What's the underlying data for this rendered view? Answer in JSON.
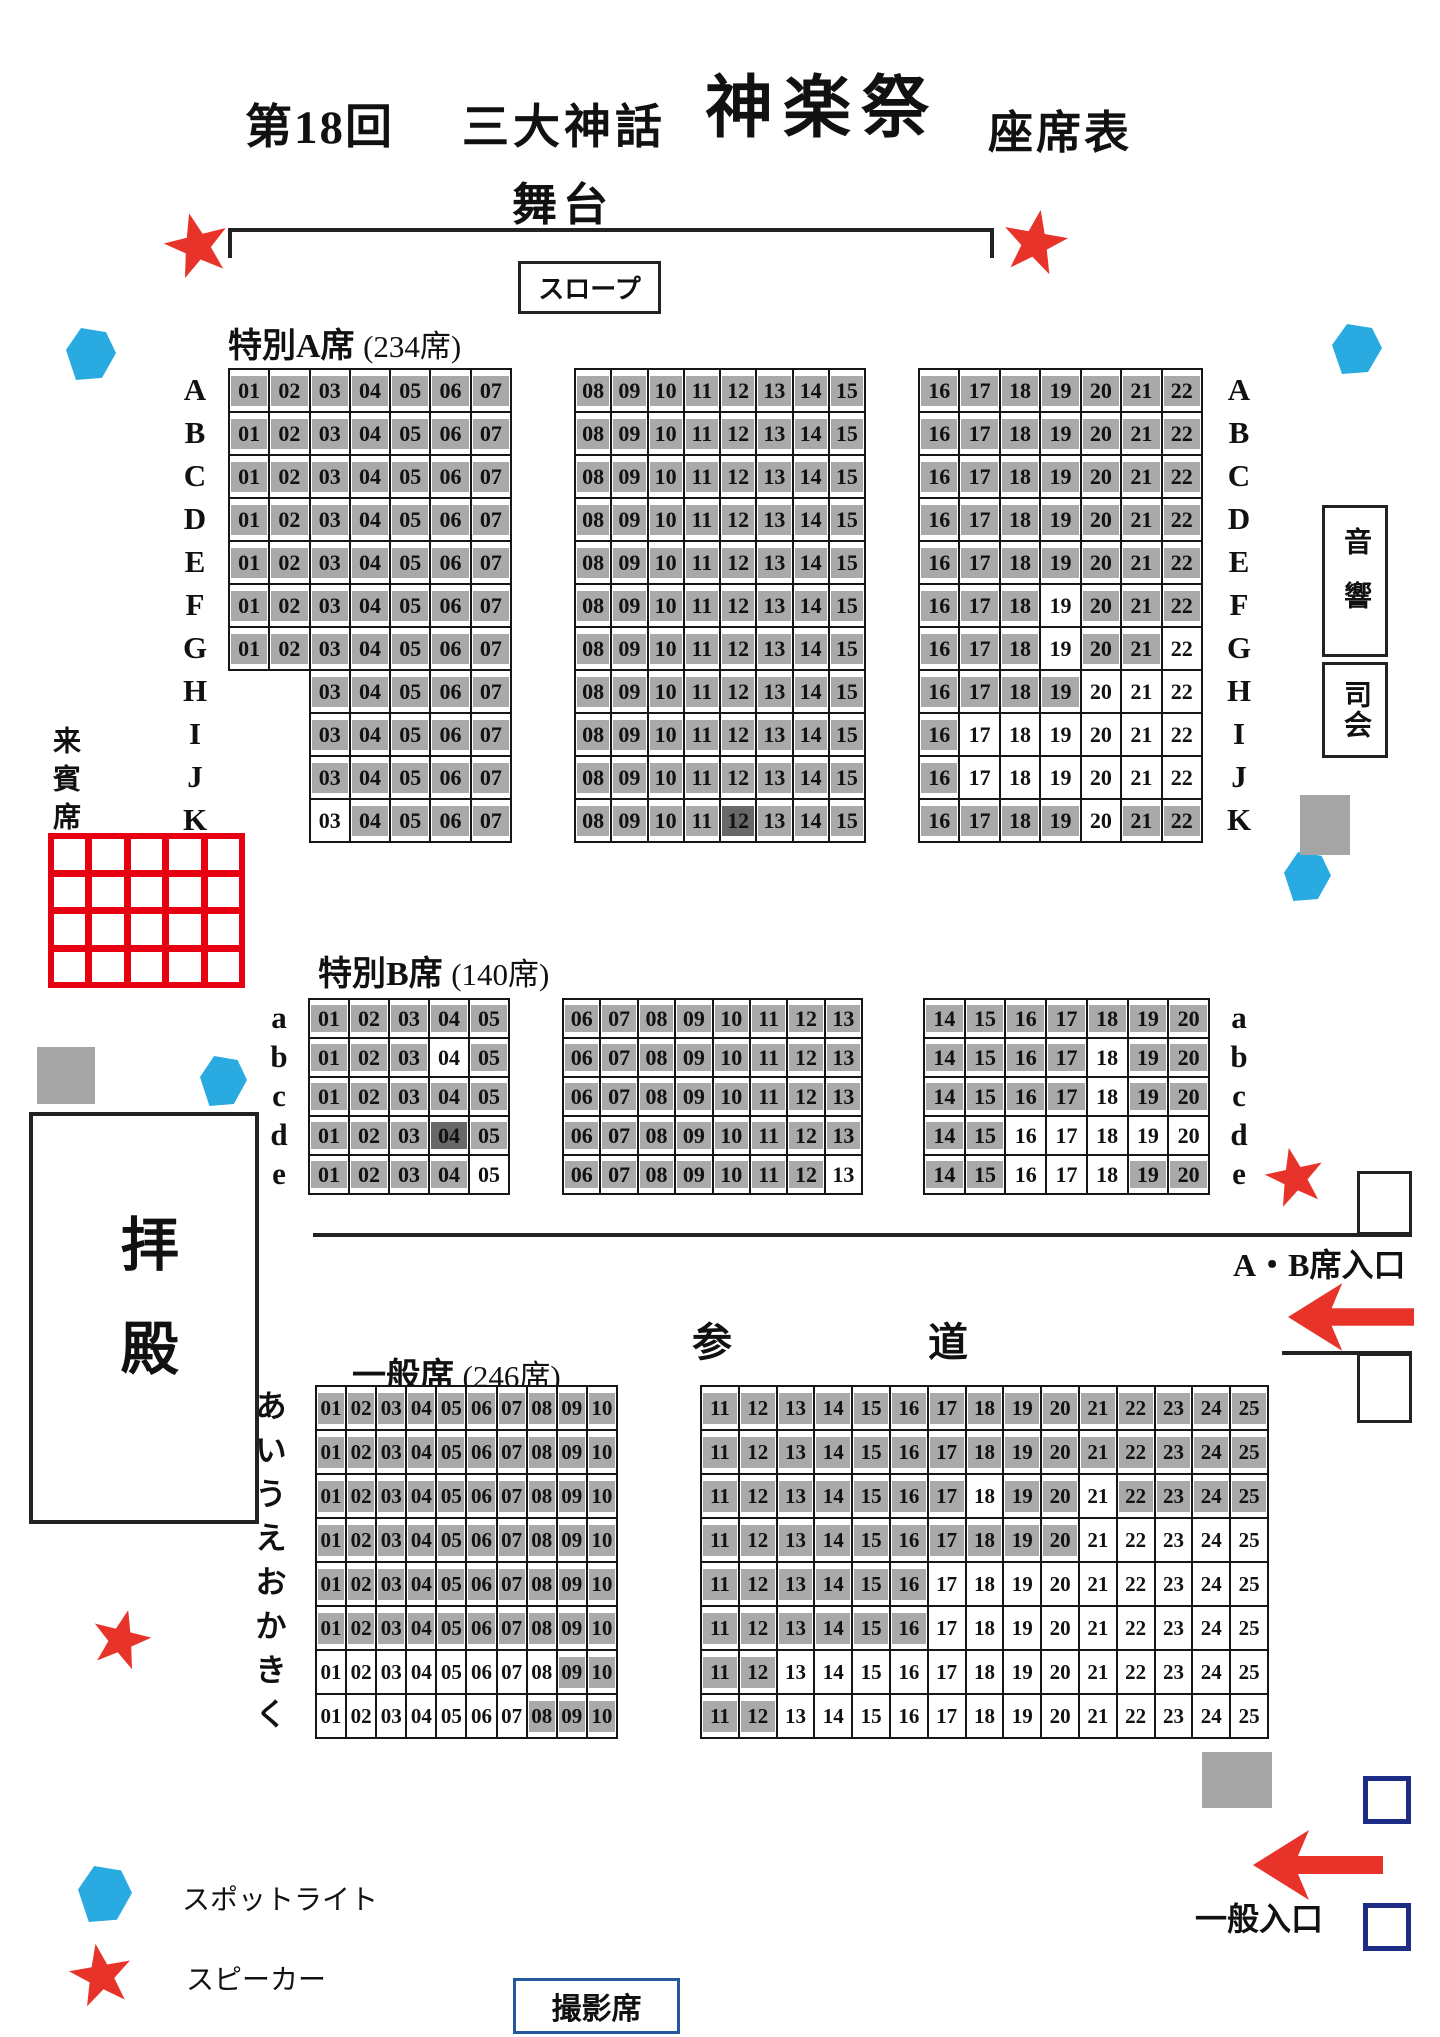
{
  "title": {
    "no": "第18回",
    "sub": "三大神話",
    "main": "神楽祭",
    "type": "座席表"
  },
  "stage_label": "舞台",
  "slope_label": "スロープ",
  "guest_label": "来賓席",
  "hall_label": "拝殿",
  "sound_label": "音響",
  "mc_label": "司会",
  "path_label": "参　道",
  "ab_entrance_label": "A・B席入口",
  "general_entrance_label": "一般入口",
  "photo_label": "撮影席",
  "legend": [
    {
      "icon": "spotlight-hexagon",
      "label": "スポットライト",
      "color": "#29abe2"
    },
    {
      "icon": "speaker-star",
      "label": "スピーカー",
      "color": "#e8332a"
    }
  ],
  "colors": {
    "seat_marked": "#a9a9a9",
    "seat_marked_dark": "#686868",
    "seat_open": "#ffffff",
    "accent_red": "#e8332a",
    "guest_grid_red": "#e60012",
    "spotlight_blue": "#29abe2",
    "entrance_square_navy": "#1d2d86",
    "photo_box_blue": "#2457a0",
    "line_black": "#1a1a1a"
  },
  "sections": [
    {
      "id": "special-a",
      "title": "特別A席",
      "count": "(234席)",
      "blocks": [
        {
          "from": 1,
          "to": 7
        },
        {
          "from": 8,
          "to": 15
        },
        {
          "from": 16,
          "to": 22
        }
      ],
      "rows": [
        {
          "label": "A",
          "white": [],
          "dark": []
        },
        {
          "label": "B",
          "white": [],
          "dark": []
        },
        {
          "label": "C",
          "white": [],
          "dark": []
        },
        {
          "label": "D",
          "white": [],
          "dark": []
        },
        {
          "label": "E",
          "white": [],
          "dark": []
        },
        {
          "label": "F",
          "white": [
            19
          ],
          "dark": []
        },
        {
          "label": "G",
          "white": [
            19,
            22
          ],
          "dark": []
        },
        {
          "label": "H",
          "start": 3,
          "white": [
            20,
            21,
            22
          ],
          "dark": []
        },
        {
          "label": "I",
          "start": 3,
          "white": [
            17,
            18,
            19,
            20,
            21,
            22
          ],
          "dark": []
        },
        {
          "label": "J",
          "start": 3,
          "white": [
            17,
            18,
            19,
            20,
            21,
            22
          ],
          "dark": []
        },
        {
          "label": "K",
          "start": 3,
          "white": [
            3,
            20
          ],
          "dark": [
            12
          ]
        }
      ]
    },
    {
      "id": "special-b",
      "title": "特別B席",
      "count": "(140席)",
      "blocks": [
        {
          "from": 1,
          "to": 5
        },
        {
          "from": 6,
          "to": 13
        },
        {
          "from": 14,
          "to": 20
        }
      ],
      "rows": [
        {
          "label": "a",
          "white": [],
          "dark": []
        },
        {
          "label": "b",
          "white": [
            4,
            18
          ],
          "dark": []
        },
        {
          "label": "c",
          "white": [
            18
          ],
          "dark": []
        },
        {
          "label": "d",
          "white": [
            16,
            17,
            18,
            19,
            20
          ],
          "dark": [
            4
          ]
        },
        {
          "label": "e",
          "white": [
            5,
            13,
            16,
            17,
            18
          ],
          "dark": []
        }
      ]
    },
    {
      "id": "general",
      "title": "一般席",
      "count": "(246席)",
      "blocks": [
        {
          "from": 1,
          "to": 10
        },
        {
          "from": 11,
          "to": 25
        }
      ],
      "rows": [
        {
          "label": "あ",
          "white": [],
          "dark": []
        },
        {
          "label": "い",
          "white": [],
          "dark": []
        },
        {
          "label": "う",
          "white": [
            18,
            21
          ],
          "dark": []
        },
        {
          "label": "え",
          "white": [
            21,
            22,
            23,
            24,
            25
          ],
          "dark": []
        },
        {
          "label": "お",
          "white": [
            17,
            18,
            19,
            20,
            21,
            22,
            23,
            24,
            25
          ],
          "dark": []
        },
        {
          "label": "か",
          "white": [
            17,
            18,
            19,
            20,
            21,
            22,
            23,
            24,
            25
          ],
          "dark": []
        },
        {
          "label": "き",
          "white": [
            1,
            2,
            3,
            4,
            5,
            6,
            7,
            8,
            13,
            14,
            15,
            16,
            17,
            18,
            19,
            20,
            21,
            22,
            23,
            24,
            25
          ],
          "dark": []
        },
        {
          "label": "く",
          "white": [
            1,
            2,
            3,
            4,
            5,
            6,
            7,
            13,
            14,
            15,
            16,
            17,
            18,
            19,
            20,
            21,
            22,
            23,
            24,
            25
          ],
          "dark": []
        }
      ]
    }
  ]
}
